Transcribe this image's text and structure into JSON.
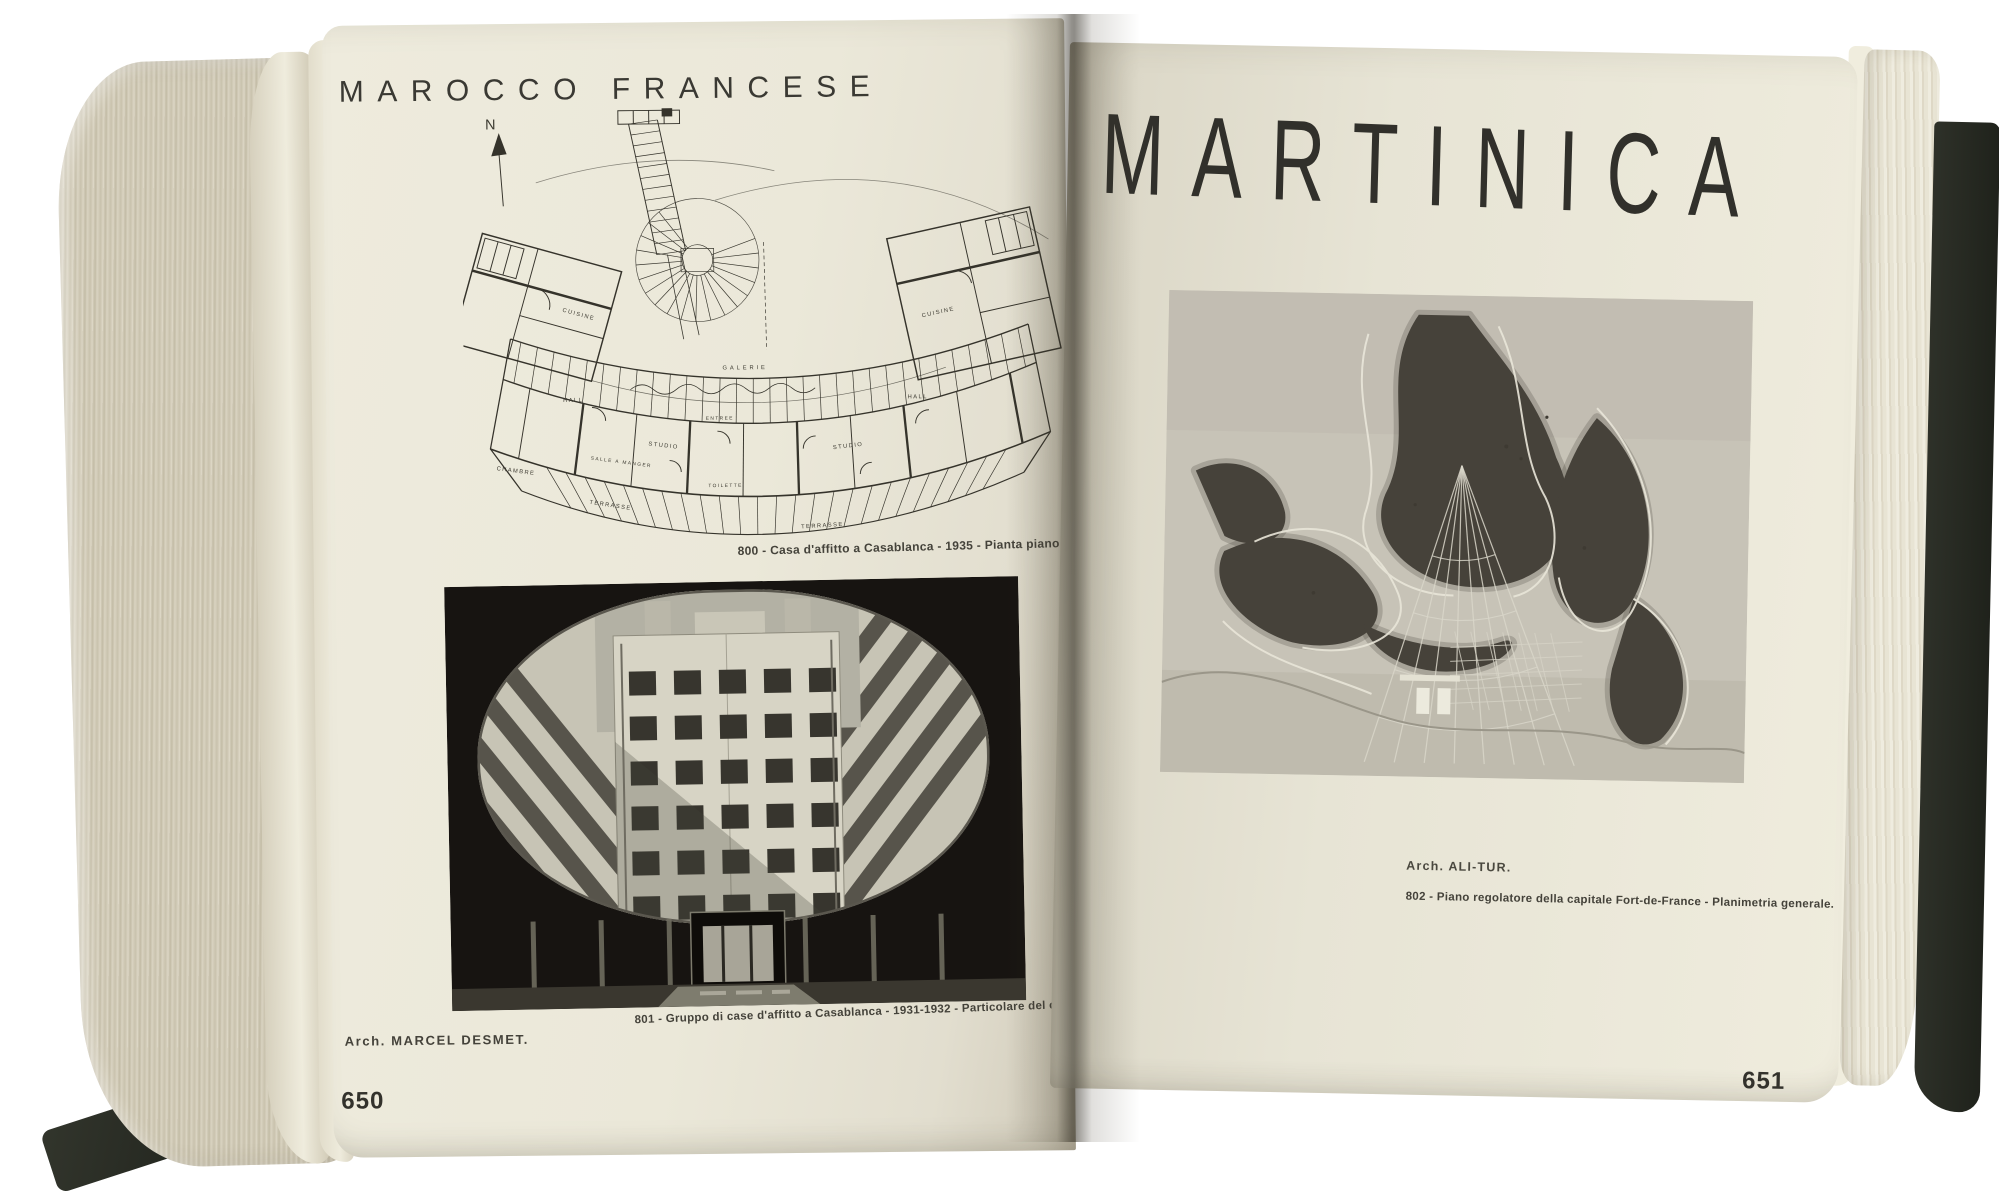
{
  "colors": {
    "paper_left": "#EAE7D8",
    "paper_right": "#E6E3D4",
    "page_edges": "#D3CDBA",
    "cover": "#2A2D26",
    "ink": "#35342E",
    "photo_dark": "#171411",
    "map_base": "#C7C3B7"
  },
  "book": {
    "left_page": {
      "header": "MAROCCO FRANCESE",
      "plan": {
        "figure_caption": "800 - Casa d'affitto a Casablanca - 1935 - Pianta piano tipo.",
        "labels": [
          "N",
          "GALERIE",
          "STUDIO",
          "STUDIO",
          "HALL",
          "HALL",
          "CUISINE",
          "CUISINE",
          "CHAMBRE",
          "ENTREE",
          "TOILETTE",
          "TERRASSE",
          "TERRASSE",
          "SALLE A MANGER"
        ]
      },
      "photo_caption": "801 - Gruppo di case d'affitto a Casablanca - 1931-1932 - Particolare del cortile.",
      "architect": "Arch. MARCEL DESMET.",
      "page_number": "650"
    },
    "right_page": {
      "header": "MARTINICA",
      "architect": "Arch. ALI-TUR.",
      "figure_caption": "802 - Piano regolatore della capitale Fort-de-France - Planimetria generale.",
      "page_number": "651"
    }
  }
}
